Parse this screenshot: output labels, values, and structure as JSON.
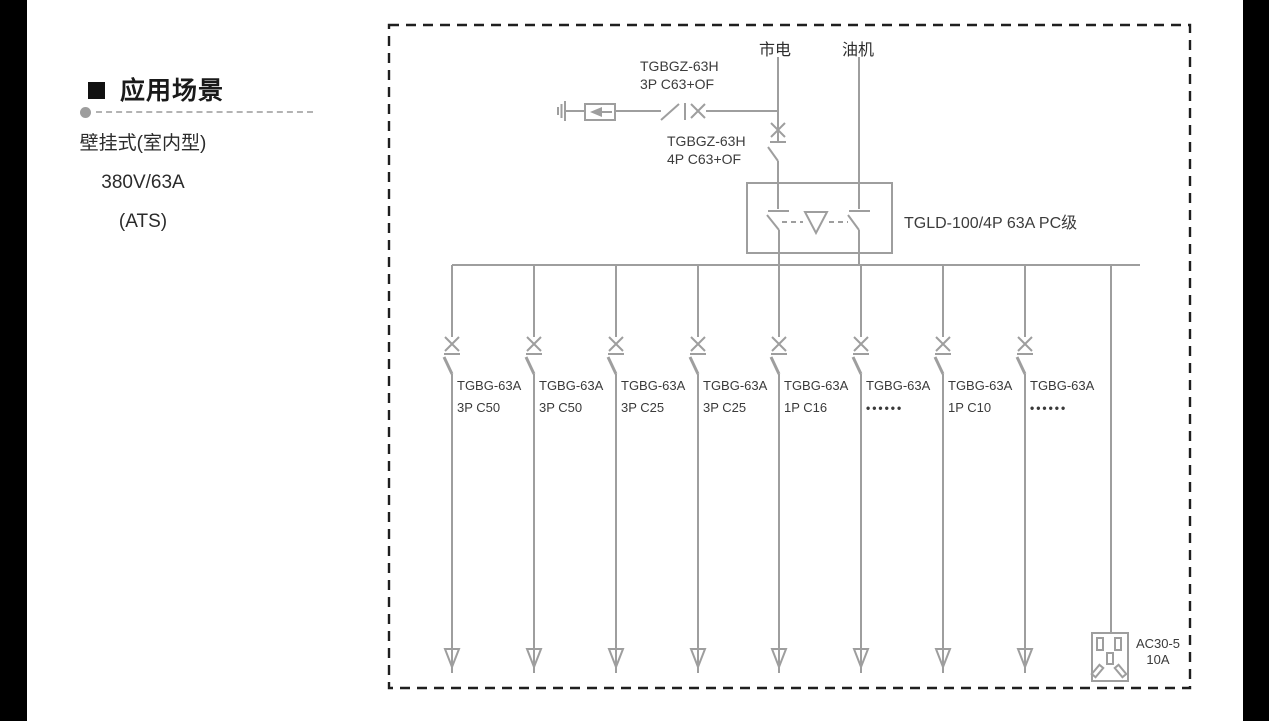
{
  "page": {
    "background": "#ffffff",
    "letterbox_color": "#000000"
  },
  "sidebar": {
    "bullet_icon": "black-square",
    "heading": "应用场景",
    "specs": [
      "壁挂式(室内型)",
      "380V/63A",
      "(ATS)"
    ]
  },
  "diagram": {
    "border_color": "#1f1f1f",
    "line_color": "#9e9e9e",
    "text_color": "#3c3c3c",
    "sources": {
      "mains_label": "市电",
      "generator_label": "油机"
    },
    "spd_breaker": {
      "model": "TGBGZ-63H",
      "spec": "3P C63+OF"
    },
    "main_breaker": {
      "model": "TGBGZ-63H",
      "spec": "4P C63+OF"
    },
    "ats_switch": {
      "label": "TGLD-100/4P 63A PC级"
    },
    "branches": [
      {
        "model": "TGBG-63A",
        "spec": "3P C50"
      },
      {
        "model": "TGBG-63A",
        "spec": "3P C50"
      },
      {
        "model": "TGBG-63A",
        "spec": "3P C25"
      },
      {
        "model": "TGBG-63A",
        "spec": "3P C25"
      },
      {
        "model": "TGBG-63A",
        "spec": "1P C16"
      },
      {
        "model": "TGBG-63A",
        "spec": "••••••"
      },
      {
        "model": "TGBG-63A",
        "spec": "1P C10"
      },
      {
        "model": "TGBG-63A",
        "spec": "••••••"
      }
    ],
    "socket": {
      "model": "AC30-5",
      "rating": "10A"
    }
  }
}
